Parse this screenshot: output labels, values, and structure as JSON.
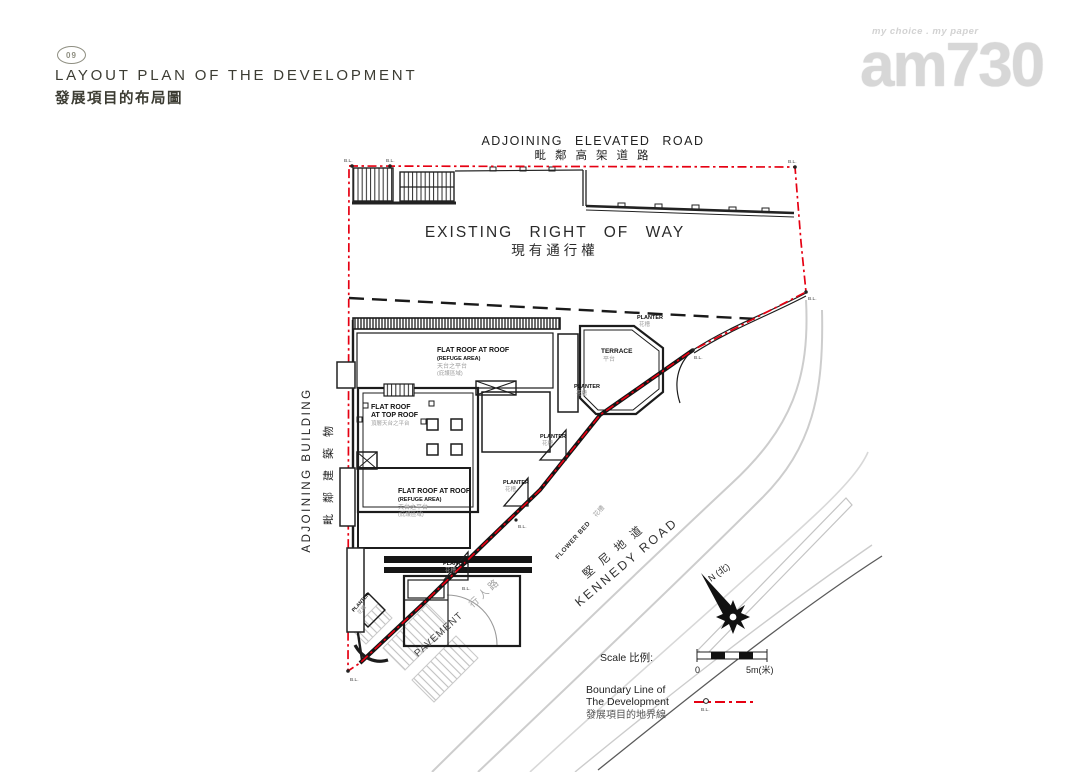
{
  "page": {
    "number": "09",
    "title_en": "LAYOUT PLAN OF THE DEVELOPMENT",
    "title_zh": "發展項目的布局圖"
  },
  "logo": {
    "tagline": "my choice . my paper",
    "name": "am730"
  },
  "plan": {
    "adjoining_elevated_road_en": "ADJOINING ELEVATED ROAD",
    "adjoining_elevated_road_zh": "毗鄰高架道路",
    "existing_right_of_way_en": "EXISTING RIGHT OF WAY",
    "existing_right_of_way_zh": "現有通行權",
    "adjoining_building_en": "ADJOINING BUILDING",
    "adjoining_building_zh": "毗鄰建築物",
    "kennedy_road_zh": "堅尼地道",
    "kennedy_road_en": "KENNEDY ROAD",
    "flower_bed_en": "FLOWER BED",
    "flower_bed_zh": "花槽",
    "pavement_en": "PAVEMENT",
    "pavement_zh": "行人路",
    "terrace_en": "TERRACE",
    "terrace_zh": "平台",
    "planter_en": "PLANTER",
    "planter_zh": "花槽",
    "flat_roof_at_roof_en": "FLAT ROOF AT ROOF",
    "refuge_area_en": "(REFUGE AREA)",
    "flat_roof_at_roof_zh": "天台之平台",
    "refuge_area_zh": "(庇護區域)",
    "flat_roof_top_en1": "FLAT ROOF",
    "flat_roof_top_en2": "AT TOP ROOF",
    "flat_roof_top_zh": "頂層天台之平台",
    "north_label": "N (北)",
    "bl": "B.L."
  },
  "legend": {
    "scale_label": "Scale 比例:",
    "scale_zero": "0",
    "scale_5m": "5m(米)",
    "boundary_line_1": "Boundary Line of",
    "boundary_line_2": "The Development",
    "boundary_zh": "發展項目的地界線",
    "bl": "B.L."
  },
  "colors": {
    "boundary_red": "#e60012",
    "dark_line": "#1a1a1a",
    "gray_text": "#9c9c9c",
    "road_gray": "#cbcbcb"
  }
}
